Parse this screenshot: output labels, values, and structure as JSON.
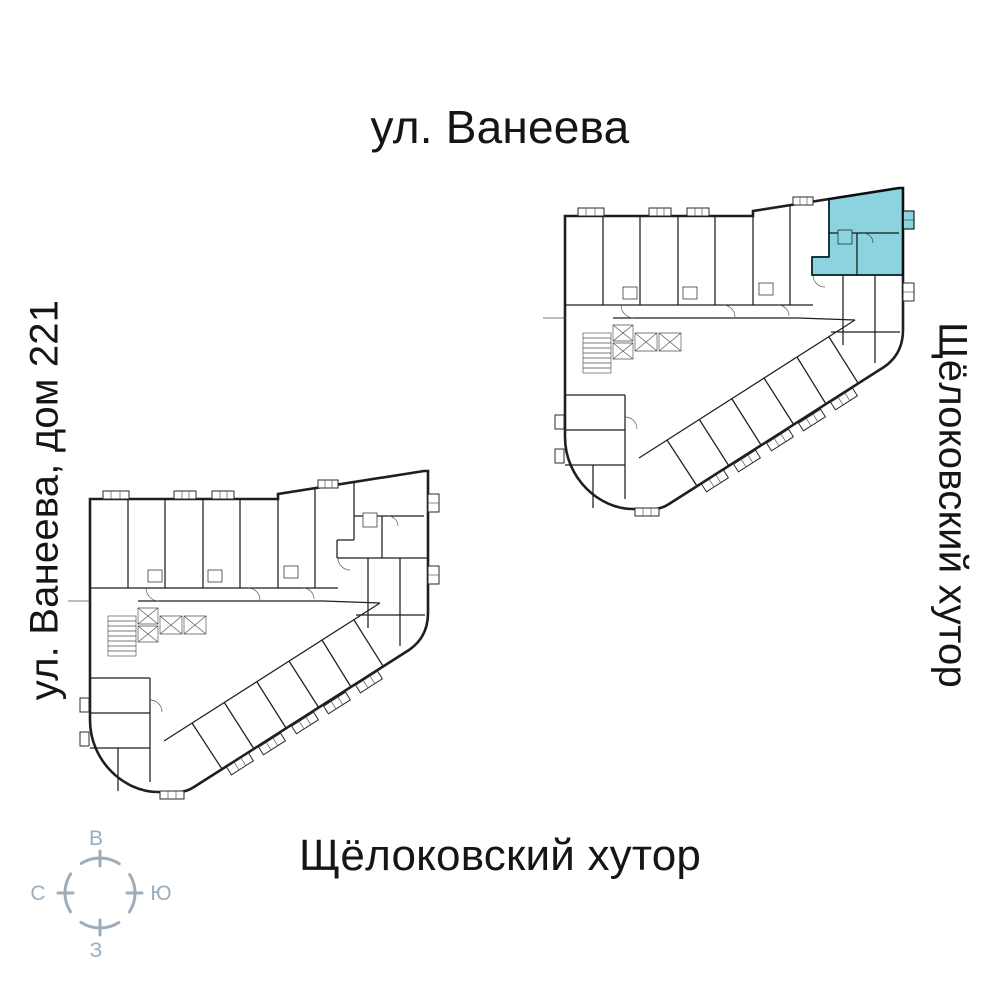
{
  "labels": {
    "street_top": "ул. Ванеева",
    "street_left": "ул. Ванеева, дом 221",
    "area_right": "Щёлоковский хутор",
    "area_bottom": "Щёлоковский хутор"
  },
  "compass": {
    "east_label": "В",
    "north_label": "С",
    "south_label": "Ю",
    "west_label": "З",
    "color": "#9dadbb"
  },
  "plan": {
    "highlight_color": "#7ecedc"
  }
}
